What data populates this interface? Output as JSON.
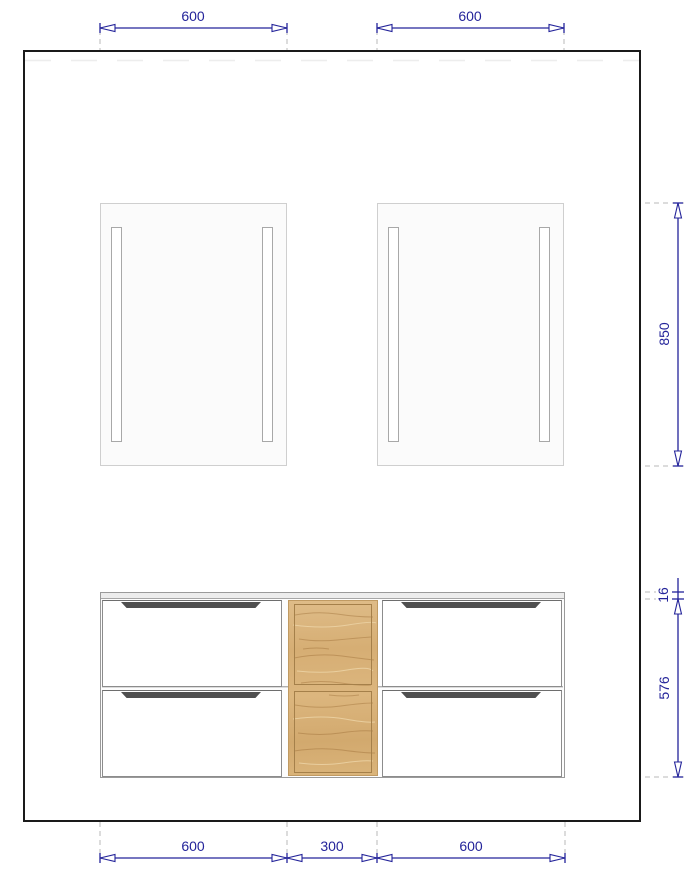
{
  "colors": {
    "dimension_accent": "#24249a",
    "wall_outline": "#1a1a1a",
    "wood": "#d8b37c",
    "drawer_groove": "#4f4f4f",
    "extension_dash": "#b8b8b8",
    "mirror_fill": "#fbfbfb"
  },
  "dimensions": {
    "top": [
      {
        "name": "left-mirror-width",
        "label": "600"
      },
      {
        "name": "right-mirror-width",
        "label": "600"
      }
    ],
    "right": [
      {
        "name": "mirror-height",
        "label": "850"
      },
      {
        "name": "carcass-top-thickness",
        "label": "16"
      },
      {
        "name": "drawer-front-height",
        "label": "576"
      }
    ],
    "bottom": [
      {
        "name": "left-vanity-width",
        "label": "600"
      },
      {
        "name": "center-cabinet-width",
        "label": "300"
      },
      {
        "name": "right-vanity-width",
        "label": "600"
      }
    ]
  }
}
